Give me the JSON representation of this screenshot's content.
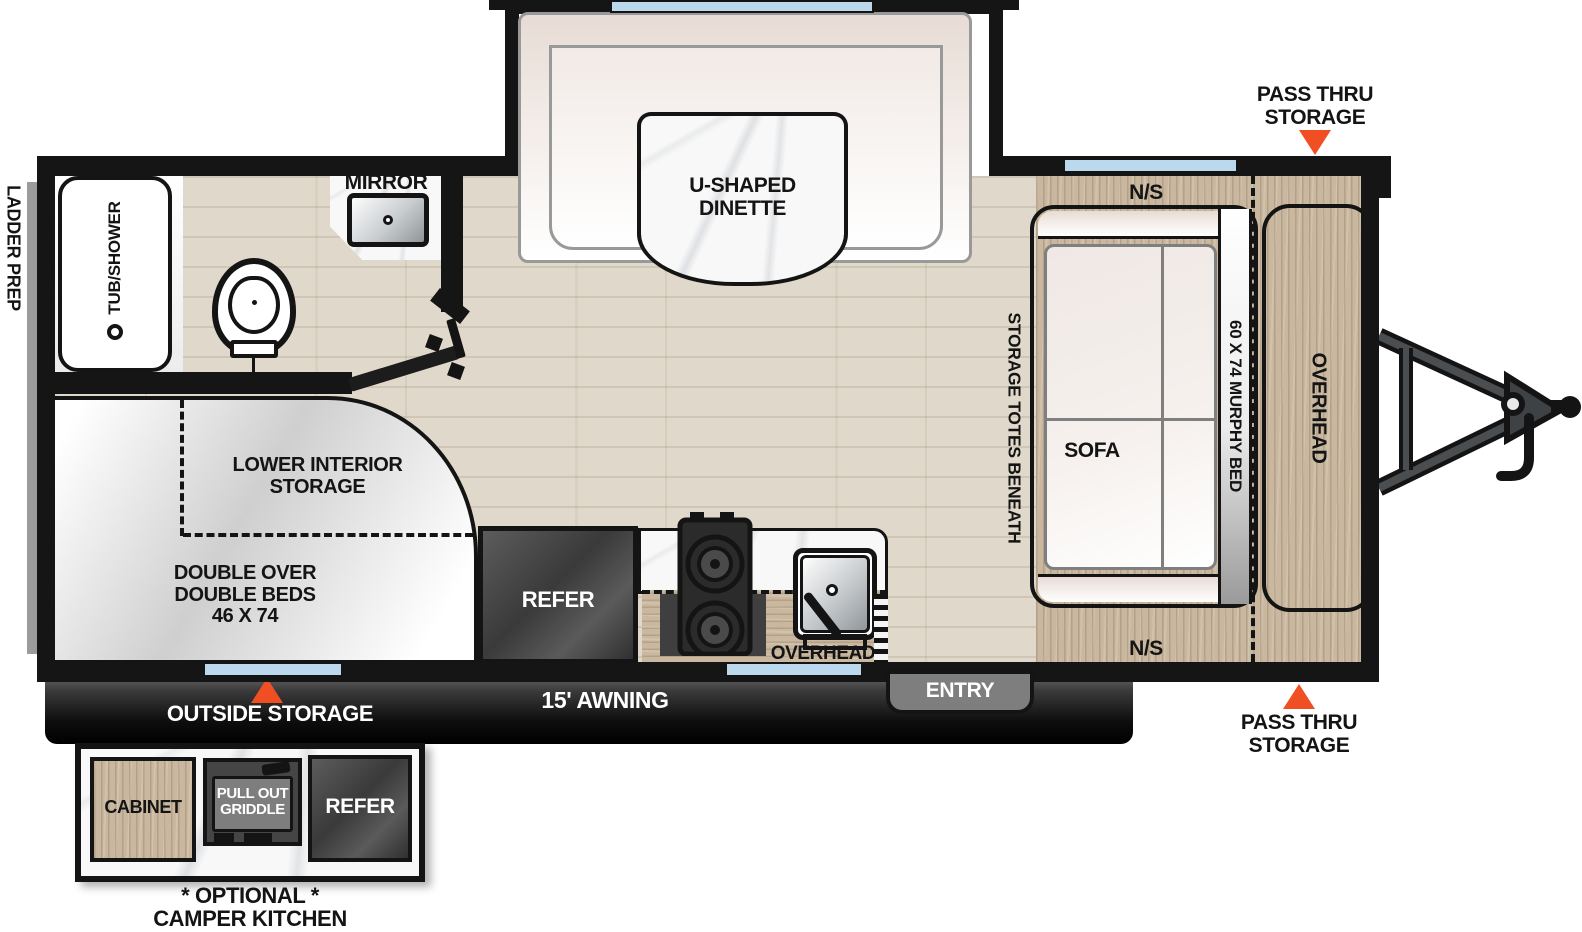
{
  "title": "Travel trailer floor plan",
  "labels": {
    "ladder_prep": "LADDER PREP",
    "tub_shower": "TUB/SHOWER",
    "mirror": "MIRROR",
    "dinette": "U-SHAPED\nDINETTE",
    "lower_storage": "LOWER INTERIOR\nSTORAGE",
    "beds": "DOUBLE OVER\nDOUBLE BEDS\n46 X 74",
    "refer": "REFER",
    "micro": "MICRO",
    "overhead_kitchen": "OVERHEAD",
    "storage_totes": "STORAGE TOTES BENEATH",
    "sofa": "SOFA",
    "murphy": "60 X 74 MURPHY BED",
    "overhead_front": "OVERHEAD",
    "ns_top": "N/S",
    "ns_bottom": "N/S",
    "pass_thru_top": "PASS THRU\nSTORAGE",
    "pass_thru_bottom": "PASS THRU\nSTORAGE",
    "awning": "15' AWNING",
    "outside_storage": "OUTSIDE STORAGE",
    "entry": "ENTRY"
  },
  "inset": {
    "cabinet": "CABINET",
    "griddle": "PULL OUT\nGRIDDLE",
    "refer": "REFER",
    "caption": "* OPTIONAL *\nCAMPER KITCHEN"
  },
  "colors": {
    "accent": "#F04E23",
    "window": "#BBD8ED",
    "wall": "#151515",
    "floor": "#E0D9CB",
    "wood": "#C9B89F",
    "fabric": "#E9DED7",
    "entry-gray": "#7E7E7E"
  }
}
